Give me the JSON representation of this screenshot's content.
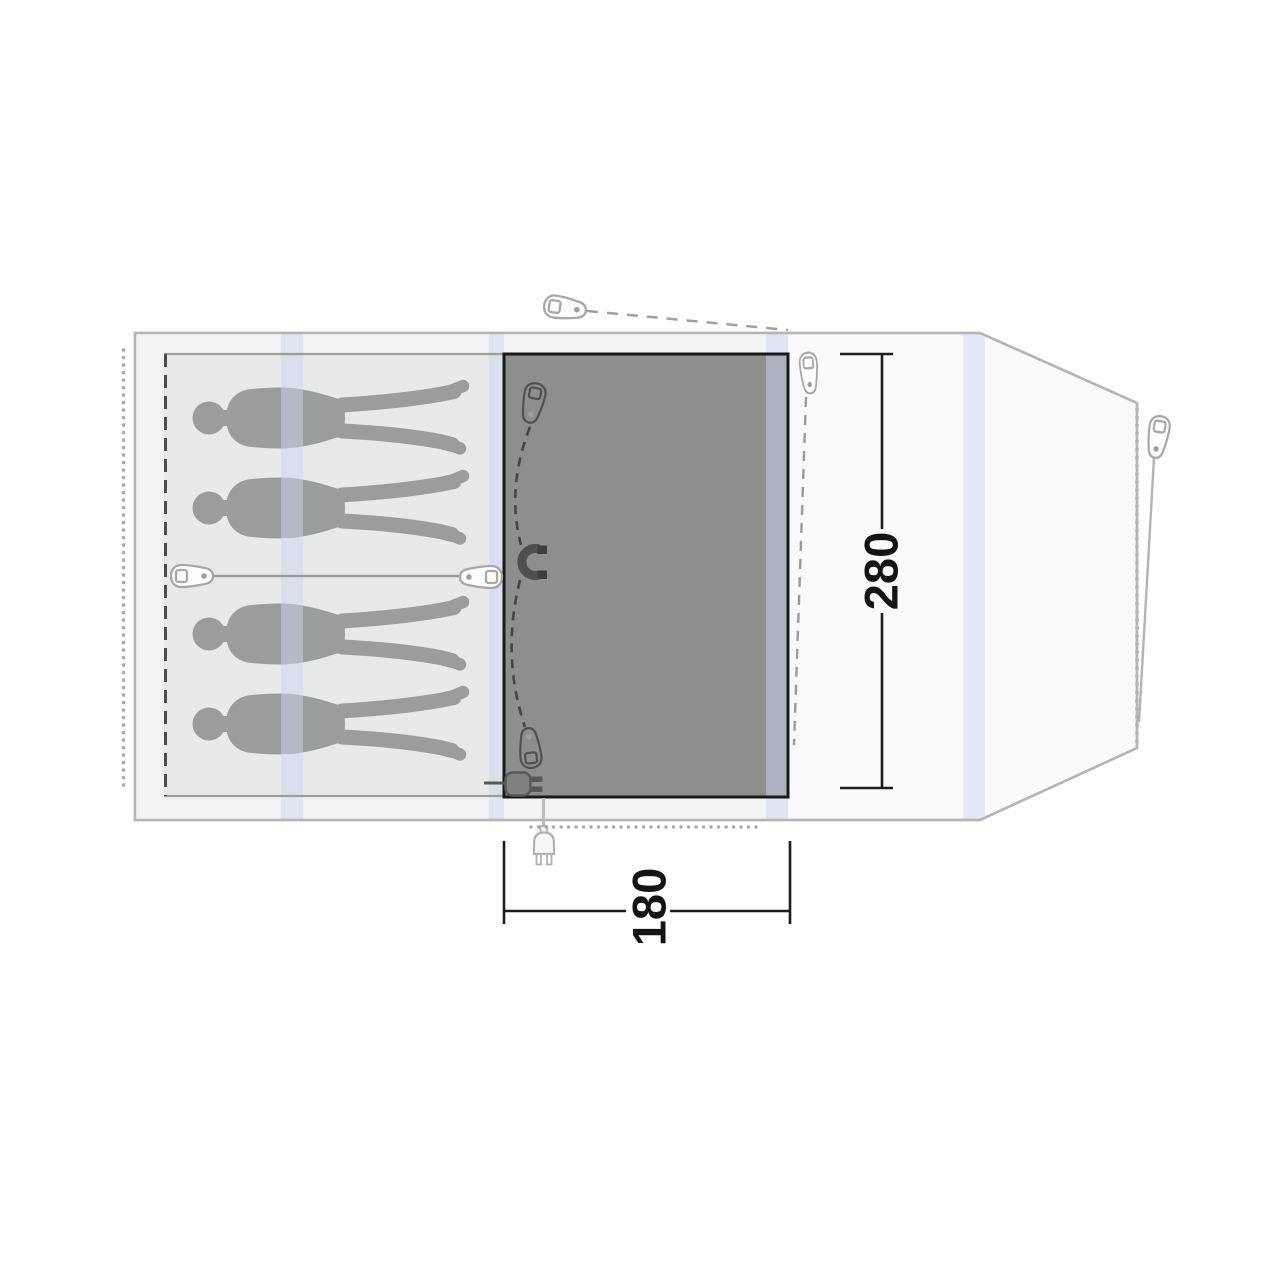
{
  "diagram": {
    "title": "tent-floorplan",
    "labels": {
      "inner_depth": "280",
      "door_width": "180"
    },
    "sleepers": 4,
    "colors": {
      "background": "#ffffff",
      "footprint_fill": "#fafafa",
      "footprint_stroke": "#b5b5b5",
      "sleeping_area_fill": "#e9e9e9",
      "inner_margin_fill": "#f3f3f4",
      "floor_panel_fill": "#8c8f8b",
      "floor_panel_border": "#1a1a1a",
      "silhouette": "#9b9d9b",
      "pole_band": "#cdd5ef",
      "dimension_color": "#1c1c1c",
      "hardware_light": "#a8a8a8",
      "hardware_dark": "#4e514e"
    },
    "icons": [
      "person-silhouette",
      "tent-peg",
      "guyline",
      "toggle",
      "magnet",
      "power-plug",
      "zipper-dots",
      "pegging-points"
    ]
  }
}
